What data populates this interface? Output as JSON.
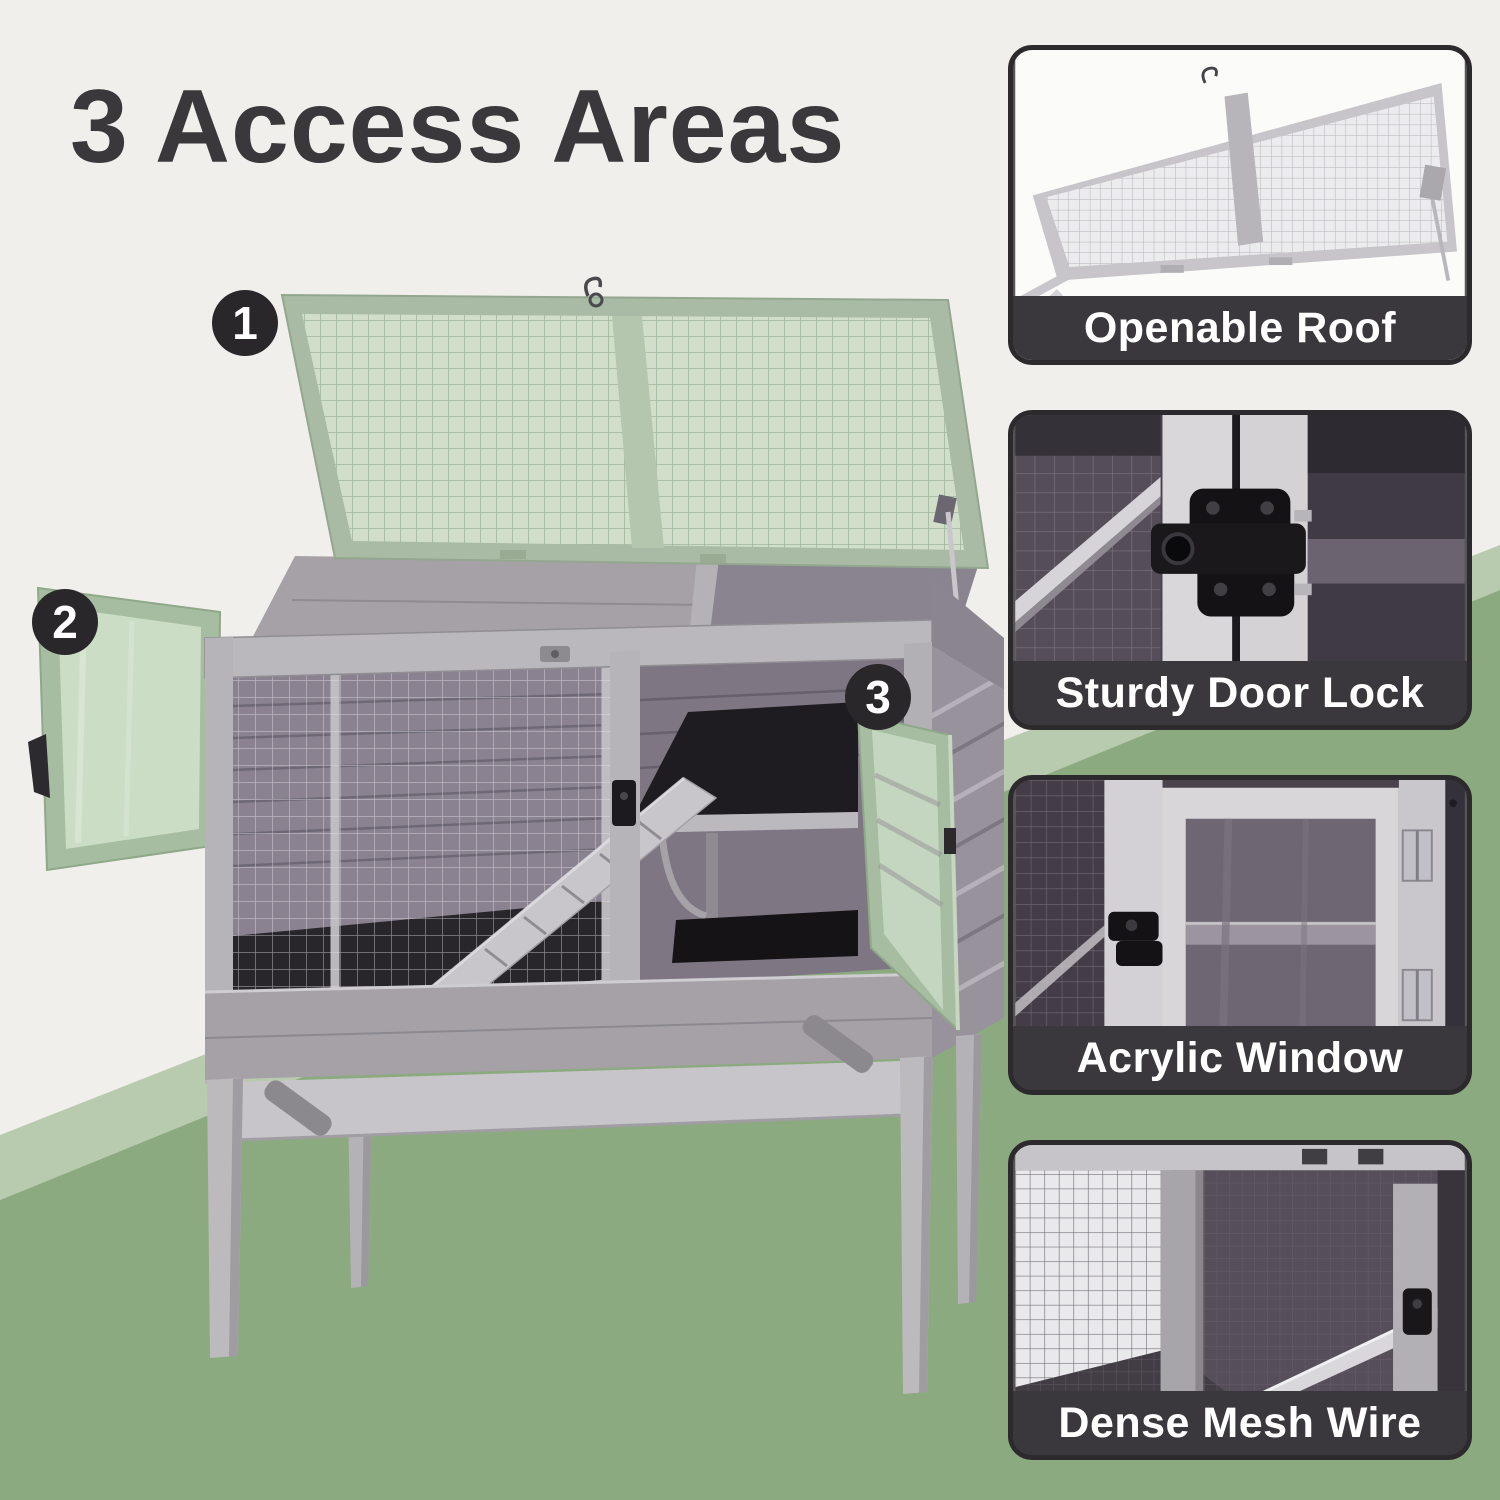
{
  "title": "3 Access Areas",
  "callouts": [
    {
      "number": "1"
    },
    {
      "number": "2"
    },
    {
      "number": "3"
    }
  ],
  "panels": [
    {
      "id": "openable-roof",
      "caption": "Openable Roof"
    },
    {
      "id": "sturdy-door-lock",
      "caption": "Sturdy Door Lock"
    },
    {
      "id": "acrylic-window",
      "caption": "Acrylic Window"
    },
    {
      "id": "dense-mesh-wire",
      "caption": "Dense Mesh Wire"
    }
  ],
  "colors": {
    "background_cream": "#f1efeb",
    "sage_light": "#b9cbae",
    "sage_dark": "#8caa7f",
    "title_text": "#3a383b",
    "badge_background": "#29272a",
    "badge_text": "#ffffff",
    "caption_band": "#3a383c",
    "caption_text": "#ffffff",
    "door_tint_green": "#cfdfc9",
    "wood_gray": "#b7b5b9"
  }
}
